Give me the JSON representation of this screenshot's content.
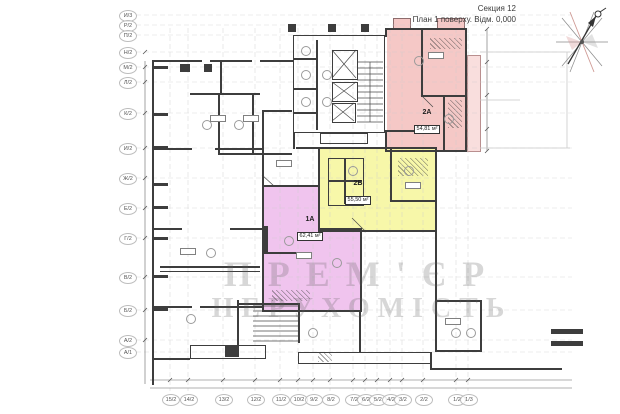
{
  "header": {
    "section": "Секция 12",
    "subtitle": "План 1 поверху. Відм. 0,000"
  },
  "axes": {
    "left": [
      "И/3",
      "Р/2",
      "П/2",
      "Н/2",
      "М/2",
      "Л/2",
      "К/2",
      "И/2",
      "Ж/2",
      "Е/2",
      "Г/2",
      "В/2",
      "Б/2",
      "А/2",
      "А/1"
    ],
    "bottom": [
      "15/2",
      "14/2",
      "13/2",
      "12/2",
      "11/2",
      "10/2",
      "9/2",
      "8/2",
      "7/2",
      "6/2",
      "5/2",
      "4/2",
      "3/2",
      "2/2",
      "1/2",
      "1/3"
    ]
  },
  "apartments": [
    {
      "id": "2А",
      "area": "54,81 м²",
      "color": "#f5c8c6"
    },
    {
      "id": "2Б",
      "area": "55,50 м²",
      "color": "#f7f7a9"
    },
    {
      "id": "1А",
      "area": "62,41 м²",
      "color": "#f0c4ee"
    }
  ],
  "watermark": {
    "line1": "ПРЕМ'ЄР",
    "line2": "НЕРУХОМІСТЬ"
  },
  "colors": {
    "pink": "#f5c8c6",
    "pink_light": "#f9dedd",
    "yellow": "#f7f7a9",
    "purple": "#f0c4ee",
    "wall": "#3d3d3d",
    "grid": "#cccccc"
  },
  "icons": {
    "compass": "north-arrow-compass"
  }
}
